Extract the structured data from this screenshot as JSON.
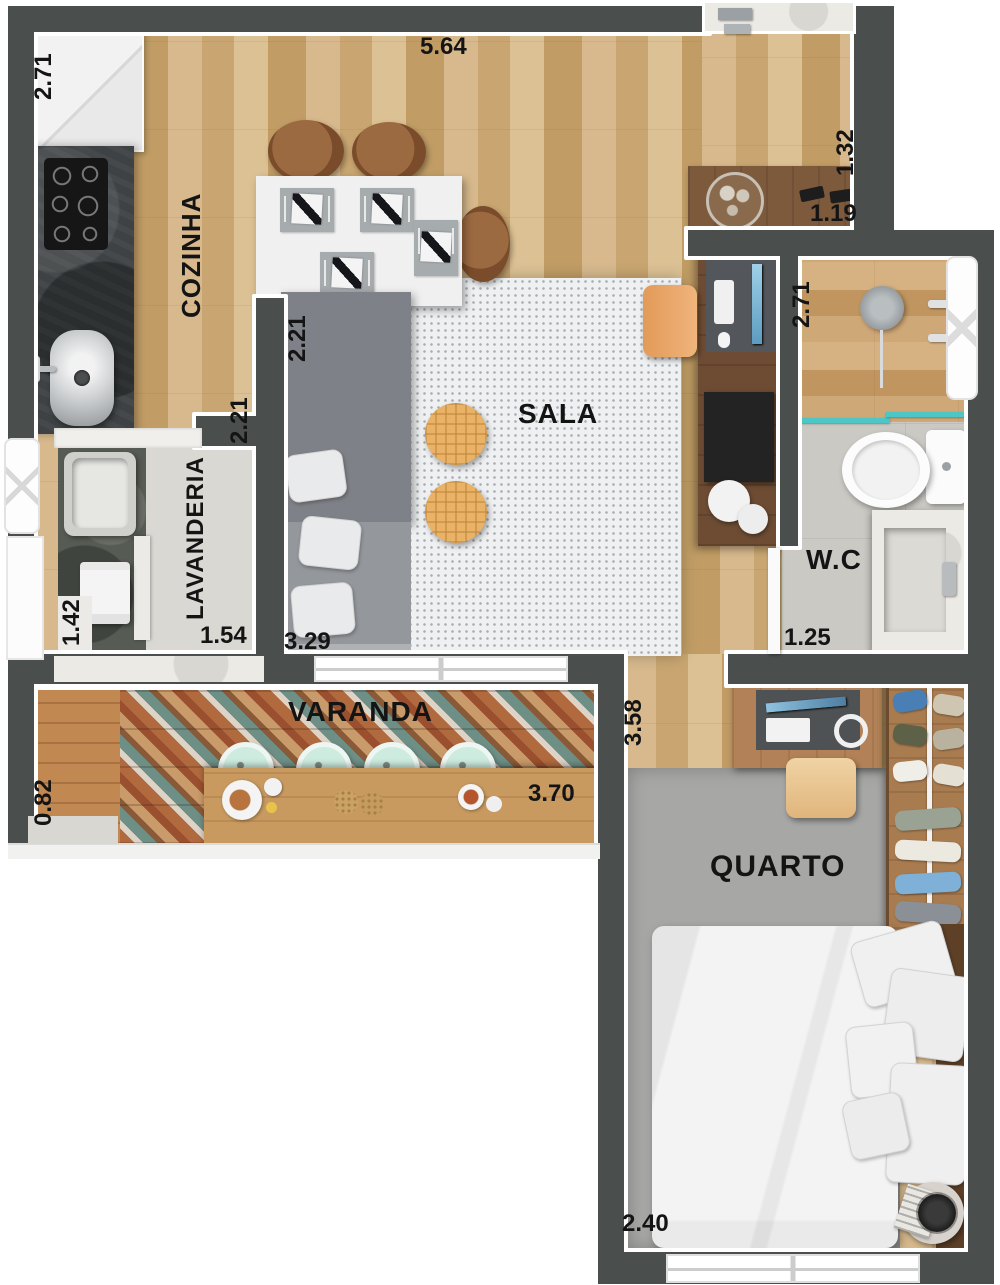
{
  "plan": {
    "rooms": {
      "cozinha": "COZINHA",
      "sala": "SALA",
      "lavanderia": "LAVANDERIA",
      "varanda": "VARANDA",
      "wc": "W.C",
      "quarto": "QUARTO"
    },
    "dimensions": {
      "kitchen_depth": "2.71",
      "top_width": "5.64",
      "hall_depth": "1.32",
      "hall_width": "1.19",
      "island_side": "2.21",
      "kitchen_width": "2.21",
      "wc_depth": "2.71",
      "wc_width": "1.25",
      "laundry_depth": "1.42",
      "laundry_width": "1.54",
      "sala_width": "3.29",
      "bedroom_depth": "3.58",
      "balcony_depth": "0.82",
      "balcony_width": "3.70",
      "bedroom_width": "2.40"
    },
    "colors": {
      "wall": "#4a4e4d",
      "wood_floor": "#d0ae7e",
      "balcony_deck": "#c28851",
      "shower_glass": "#4fc6c6",
      "label_text": "#141414"
    }
  }
}
